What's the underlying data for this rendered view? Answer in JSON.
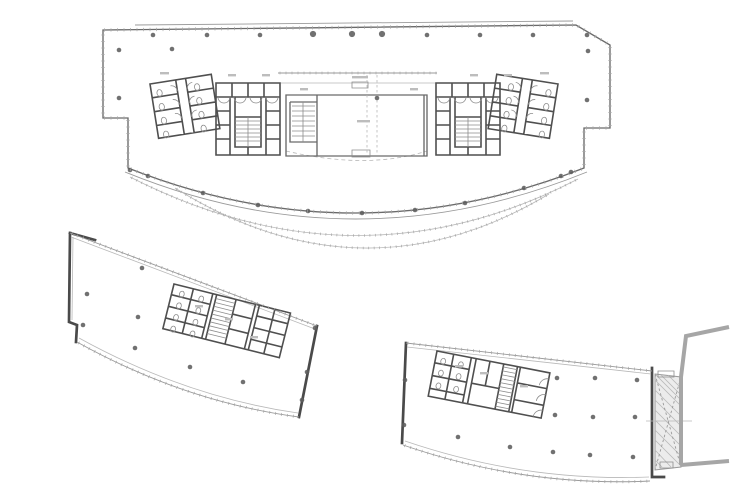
{
  "canvas": {
    "width": 730,
    "height": 491,
    "background": "#ffffff"
  },
  "palette": {
    "paper": "#ffffff",
    "wall_dark": "#4a4a4a",
    "wall_medium": "#6a6a6a",
    "line": "#8d8d8d",
    "line_light": "#b8b8b8",
    "column_dot": "#5d5d5d",
    "gray_band": "#a6a6a6",
    "hatch_fill": "#ececec",
    "label_smudge": "#bdbdbd"
  },
  "plans": {
    "upper": {
      "label": "upper-tower-floor-plan",
      "outline_d": "M128,168 L128,118 L103,118 L103,30 L576,25 L610,45 L610,128 L584,128 L584,168 Q355,258 128,168 Z",
      "top_face_d": "M135,25 L573,21",
      "arc_face_d": "M125,172 Q355,266 587,172",
      "canopy1_d": "M130,177 Q358,293 578,179",
      "canopy2_d": "M175,188 Q363,305 549,194",
      "corridor_front_d": "M278,73 L437,73",
      "corridor_line2_d": "M278,83 L437,83",
      "corridor_dash_d": "M286,151 Q367,170 427,151",
      "lobby_wall_d": "M286,95 L427,95 L427,156 L286,156 Z M317,95 L317,156 M424,95 L424,156 M290,102 L317,102 L317,142 L290,142 L290,102",
      "lobby_detail_d": "M352,82 h16 v6 h-16 Z M352,150 h18 v7 h-18 Z M292,106 h23 M292,111 h23 M292,116 h23 M292,121 h23 M292,126 h23 M292,131 h23 M292,136 h23 M303,102 L303,142",
      "lobby_grid_d": "M367,75 L367,155 M377,75 L377,155",
      "core_wall_d": "M0,5 H64 V77 H0 Z M0,19 H64 M16,5 V19 M32,5 V19 M48,5 V19 M14,19 V77 M50,19 V77 M19,39 H45 V69 H19 Z M0,33 H14 M0,47 H14 M0,61 H14 M50,33 H64 M50,47 H64 M50,61 H64 M19,19 V39 M45,19 V39 M32,69 V77",
      "core_detail_d": "M2,19 A6,6 0 0 0 14,19 M18,19 A6,6 0 0 0 30,19 M34,19 A6,6 0 0 0 46,19 M50,19 A6,6 0 0 0 62,19 M19,43 H45 M19,47 H45 M19,51 H45 M19,55 H45 M19,59 H45 M19,63 H45 M32,39 V69",
      "wing_wall_d": "M0,0 H62 V55 H0 Z M26,0 V55 M36,0 V55 M0,14 H26 M0,28 H26 M0,42 H26 M36,14 H62 M36,28 H62 M36,42 H62",
      "wing_detail_d": "M8,7 a2.6,3.4 0 1 0 0.1,0 M8,21 a2.6,3.4 0 1 0 0.1,0 M8,35 a2.6,3.4 0 1 0 0.1,0 M8,49 a2.6,3.4 0 1 0 0.1,0 M46,7 a2.6,3.4 0 1 0 0.1,0 M46,21 a2.6,3.4 0 1 0 0.1,0 M46,35 a2.6,3.4 0 1 0 0.1,0 M46,49 a2.6,3.4 0 1 0 0.1,0 M26,11 A6,6 0 0 0 20,5 M26,25 A6,6 0 0 0 20,19 M26,39 A6,6 0 0 0 20,33 M36,11 A6,6 0 0 1 42,5 M36,25 A6,6 0 0 1 42,19 M36,39 A6,6 0 0 1 42,33",
      "left_core_tf": "translate(216,78)",
      "right_core_tf": "translate(500,78) scale(-1,1)",
      "left_wing_tf": "translate(150,84) rotate(-9)",
      "right_wing_tf": "translate(558,84) scale(-1,1) rotate(-9)",
      "columns": [
        [
          153,
          35
        ],
        [
          207,
          35
        ],
        [
          260,
          35
        ],
        [
          427,
          35
        ],
        [
          480,
          35
        ],
        [
          533,
          35
        ],
        [
          587,
          35
        ],
        [
          119,
          50
        ],
        [
          172,
          49
        ],
        [
          119,
          98
        ],
        [
          588,
          51
        ],
        [
          587,
          100
        ],
        [
          377,
          98
        ],
        [
          130,
          170
        ],
        [
          148,
          176
        ],
        [
          203,
          193
        ],
        [
          258,
          205
        ],
        [
          308,
          211
        ],
        [
          362,
          213
        ],
        [
          415,
          210
        ],
        [
          465,
          203
        ],
        [
          524,
          188
        ],
        [
          561,
          176
        ],
        [
          571,
          172
        ]
      ],
      "columns_big": [
        [
          313,
          34
        ],
        [
          352,
          34
        ],
        [
          382,
          34
        ]
      ],
      "smudges": [
        [
          352,
          76,
          16
        ],
        [
          357,
          120,
          13
        ],
        [
          300,
          88,
          8
        ],
        [
          410,
          88,
          8
        ],
        [
          228,
          74,
          8
        ],
        [
          262,
          74,
          8
        ],
        [
          470,
          74,
          8
        ],
        [
          504,
          74,
          8
        ],
        [
          160,
          72,
          9
        ],
        [
          540,
          72,
          9
        ]
      ]
    },
    "lower_left": {
      "label": "lower-left-podium-floor-plan",
      "thick_d": "M70,233 L95,240 M70,233 L69,322 L77,325 L76,342 M317,326 L299,417",
      "left_inner_d": "M73,237 L72,320",
      "top_d": "M70,233 L317,326",
      "top_inner_d": "M71,237 L315,329",
      "bottom_d": "M77,342 Q185,402 299,417",
      "bottom_inner_d": "M79,338 Q186,397 298,413",
      "core_tf": "translate(174,284) rotate(14)",
      "core_wall_d": "M0,0 H120 V46 H0 Z M20,0 V46 M40,0 V46 M0,11 H40 M0,23 H40 M0,35 H40 M44,0 V46 M64,0 V46 M84,0 V46 M64,15 H84 M64,30 H84 M88,0 V46 M104,0 V46 M88,11 H120 M88,23 H120 M88,35 H120",
      "core_detail_d": "M44,4 H64 M44,8 H64 M44,12 H64 M44,16 H64 M44,20 H64 M44,24 H64 M44,28 H64 M44,32 H64 M44,36 H64 M44,40 H64 M10,5 a2.4,3 0 1 0 0.1,0 M10,17 a2.4,3 0 1 0 0.1,0 M10,29 a2.4,3 0 1 0 0.1,0 M10,41 a2.4,3 0 1 0 0.1,0 M30,5 a2.4,3 0 1 0 0.1,0 M30,17 a2.4,3 0 1 0 0.1,0 M30,29 a2.4,3 0 1 0 0.1,0 M30,41 a2.4,3 0 1 0 0.1,0",
      "columns": [
        [
          87,
          294
        ],
        [
          83,
          325
        ],
        [
          142,
          268
        ],
        [
          138,
          317
        ],
        [
          135,
          348
        ],
        [
          190,
          367
        ],
        [
          243,
          382
        ],
        [
          315,
          328
        ],
        [
          307,
          372
        ],
        [
          302,
          400
        ]
      ],
      "smudges": [
        [
          195,
          305,
          8
        ],
        [
          225,
          318,
          8
        ],
        [
          250,
          336,
          8
        ]
      ]
    },
    "lower_right": {
      "label": "lower-right-podium-floor-plan",
      "thick_d": "M406,343 L402,443 M652,368 L652,477 L664,477",
      "top_d": "M406,343 L652,371",
      "top_inner_d": "M407,347 L651,374",
      "bottom_d": "M403,445 Q525,487 650,481",
      "bottom_inner_d": "M405,441 Q525,482 649,477",
      "core_tf": "translate(437,351) rotate(11)",
      "core_wall_d": "M0,0 H115 V46 H0 Z M17,0 V46 M35,0 V46 M0,12 H35 M0,25 H35 M0,38 H35 M40,0 V46 M54,0 V25 M40,25 H68 M68,0 V46 M82,0 V46 M85,0 V46 M85,16 H115 M85,33 H115",
      "core_detail_d": "M68,3 H82 M68,7 H82 M68,11 H82 M68,15 H82 M68,19 H82 M68,23 H82 M68,27 H82 M68,31 H82 M68,35 H82 M68,39 H82 M68,43 H82 M8,6 a2.4,3 0 1 0 0.1,0 M8,18 a2.4,3 0 1 0 0.1,0 M8,31 a2.4,3 0 1 0 0.1,0 M26,6 a2.4,3 0 1 0 0.1,0 M26,18 a2.4,3 0 1 0 0.1,0 M26,31 a2.4,3 0 1 0 0.1,0 M115,6 A8,8 0 0 0 107,14 M115,22 A8,8 0 0 0 107,30 M115,38 A8,8 0 0 0 107,46",
      "columns": [
        [
          405,
          380
        ],
        [
          404,
          425
        ],
        [
          458,
          437
        ],
        [
          510,
          447
        ],
        [
          557,
          378
        ],
        [
          595,
          378
        ],
        [
          637,
          380
        ],
        [
          555,
          415
        ],
        [
          593,
          417
        ],
        [
          635,
          417
        ],
        [
          553,
          452
        ],
        [
          590,
          455
        ],
        [
          633,
          457
        ]
      ],
      "bridge_rect_d": "M655,374 L681,377 L681,467 L655,470 Z",
      "bridge_hatch_d": "M655,380 L681,406 M655,390 L681,416 M655,400 L681,426 M655,410 L681,436 M655,420 L681,446 M655,430 L681,456 M655,440 L681,466 M655,374 L681,400 M661,375 L681,395 M668,375 L681,388 M655,450 L671,467 M655,460 L662,467",
      "bridge_x_d": "M655,374 L681,467 M681,377 L655,470",
      "bridge_boxes_d": "M658,371 h16 v6 h-16 Z M660,462 h13 v6 h-13 Z",
      "bridge_center_d": "M646,421 L692,421",
      "gray_d": "M681,377 L686,336 L729,327 M681,465 L729,461 M681,377 L681,465",
      "smudges": [
        [
          455,
          365,
          8
        ],
        [
          480,
          372,
          8
        ],
        [
          520,
          385,
          8
        ]
      ]
    }
  }
}
